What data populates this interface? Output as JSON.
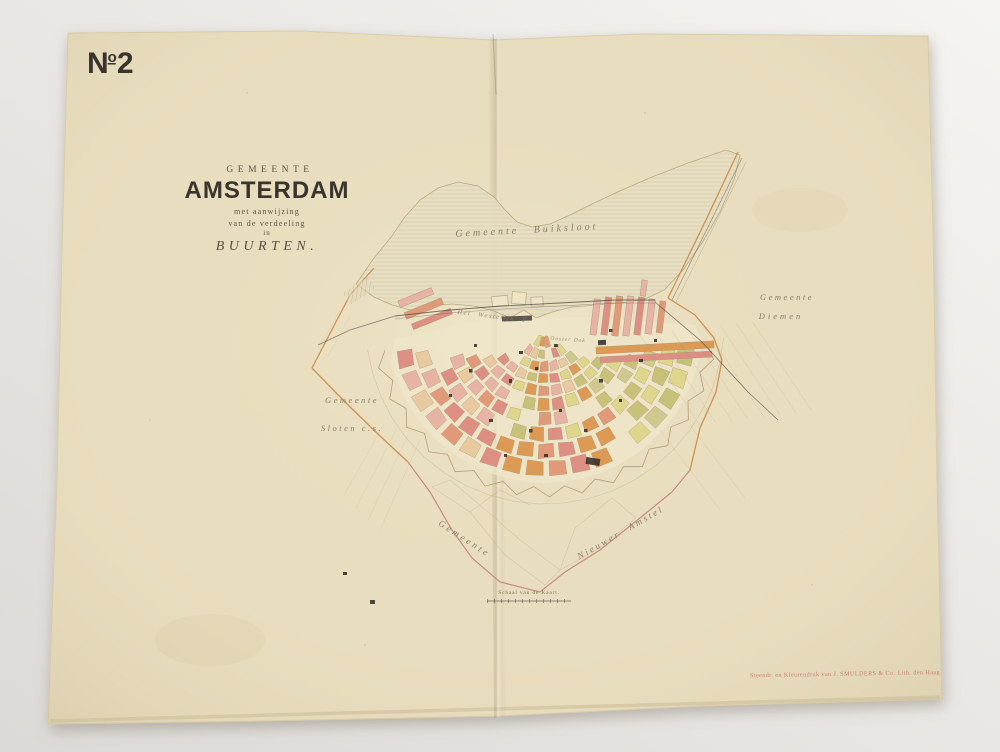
{
  "sheet": {
    "number_label": {
      "n": "N",
      "sup": "o",
      "num": "2"
    },
    "title_block": {
      "line1": "GEMEENTE",
      "line2": "AMSTERDAM",
      "line3": "met aanwijzing",
      "line4": "van de verdeeling",
      "line5": "in",
      "line6": "BUURTEN."
    },
    "map_labels": {
      "north": "Gemeente Buiksloot",
      "east_1": "Gemeente",
      "east_2": "Diemen",
      "west_1": "Gemeente",
      "west_2": "Sloten c.s.",
      "south_west": "Gemeente",
      "south_east": "Nieuwer Amstel",
      "water": "Het Westelijk Y",
      "dock": "Ooster Dok"
    },
    "scale": {
      "caption": "Schaal van de Kaart."
    },
    "imprint": "Steendr. en Kleurendruk van J. SMULDERS & Co. Lith. den Haag",
    "palette": {
      "paper": "#e8ddbe",
      "paper_edge": "#d6c8a5",
      "water_fill": "#e7dfc4",
      "hatch": "#d2c7a2",
      "ink_dark": "#39352d",
      "ink_mid": "#5a523f",
      "ink_label": "#867d66",
      "boundary_orange": "#c98a45",
      "boundary_pink": "#c4837a",
      "rail_dark": "#453f38",
      "imprint_red": "#c3736c",
      "blocks": [
        "#e7b3a4",
        "#e09a79",
        "#dd9a55",
        "#ddd68c",
        "#c8c179",
        "#dc8f82",
        "#e8c9a0",
        "#cfc98f"
      ]
    }
  }
}
